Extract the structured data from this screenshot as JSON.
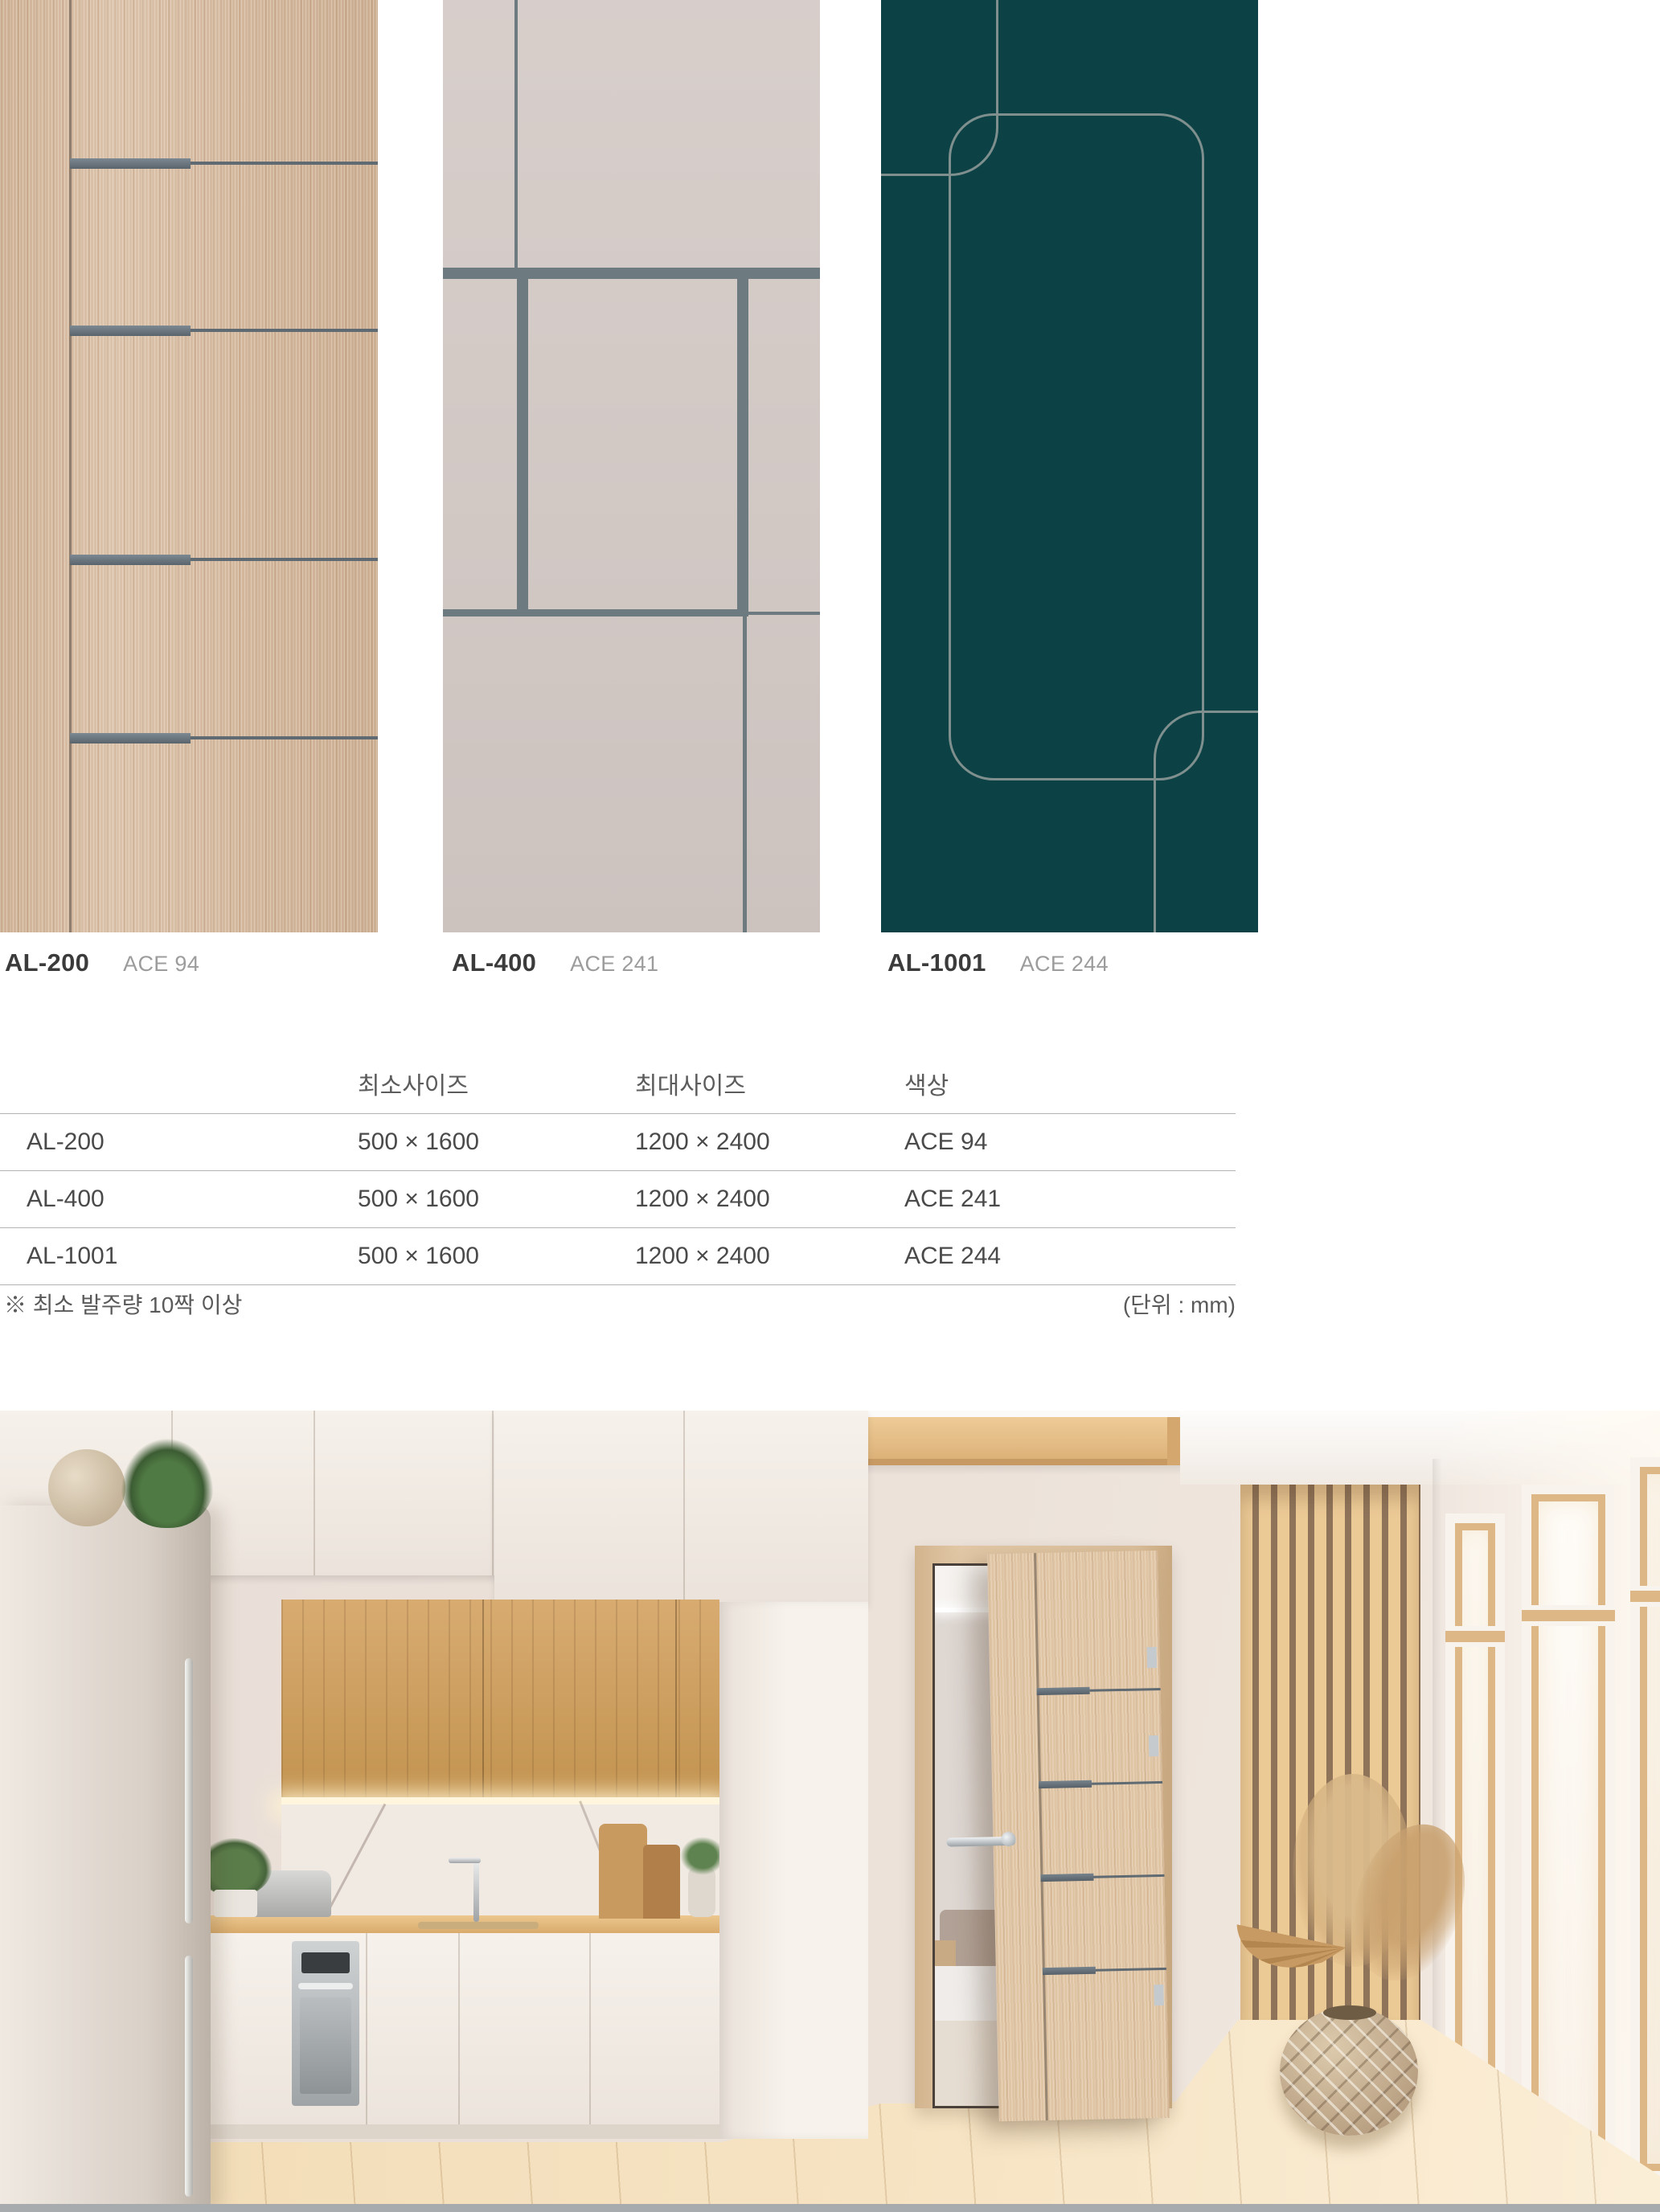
{
  "colors": {
    "accent_wood": "#d7bda4",
    "accent_wood_line": "#5f6a72",
    "strip_metal": "#6b7780",
    "greige": "#d3c9c5",
    "greige_line": "#6d7a80",
    "teal": "#0c4245",
    "teal_line": "#7e8f8e",
    "table_line": "#b3b3b3",
    "text_dark": "#3b3b3b",
    "text_gray": "#9c9c9c",
    "table_text": "#4a4a4a"
  },
  "swatches": [
    {
      "code": "AL-200",
      "finish": "ACE 94"
    },
    {
      "code": "AL-400",
      "finish": "ACE 241"
    },
    {
      "code": "AL-1001",
      "finish": "ACE 244"
    }
  ],
  "table": {
    "headers": [
      "",
      "최소사이즈",
      "최대사이즈",
      "색상"
    ],
    "rows": [
      {
        "model": "AL-200",
        "min_size": "500 × 1600",
        "max_size": "1200 × 2400",
        "color": "ACE 94"
      },
      {
        "model": "AL-400",
        "min_size": "500 × 1600",
        "max_size": "1200 × 2400",
        "color": "ACE 241"
      },
      {
        "model": "AL-1001",
        "min_size": "500 × 1600",
        "max_size": "1200 × 2400",
        "color": "ACE 244"
      }
    ],
    "footnote_left": "※ 최소 발주량 10짝 이상",
    "footnote_right": "(단위 : mm)"
  }
}
